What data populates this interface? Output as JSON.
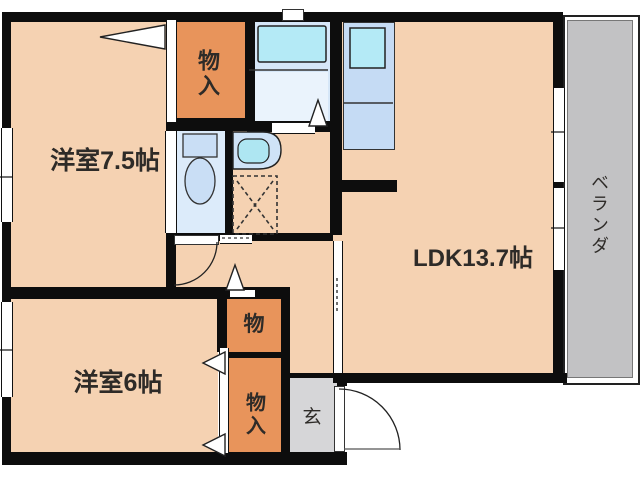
{
  "floorplan": {
    "type": "apartment-floor-plan",
    "rooms": {
      "bedroom1": {
        "label": "洋室7.5帖"
      },
      "bedroom2": {
        "label": "洋室6帖"
      },
      "ldk": {
        "label": "LDK13.7帖"
      },
      "closet_top": {
        "label": "物入"
      },
      "closet_mid": {
        "label": "物"
      },
      "closet_bottom": {
        "label": "物入"
      },
      "entrance": {
        "label": "玄"
      },
      "veranda": {
        "label": "ベランダ"
      }
    },
    "colors": {
      "room_floor": "#f5d2b2",
      "closet": "#e8945b",
      "veranda": "#c2c2c4",
      "entrance_floor": "#d6d6d8",
      "wet_area": "#d6e7f8",
      "toilet_room": "#dcebfa",
      "fixture_cyan": "#b4eaf6",
      "kitchen_unit": "#c5dbf4",
      "wall": "#0d0d0d",
      "text": "#2e2b28"
    }
  }
}
